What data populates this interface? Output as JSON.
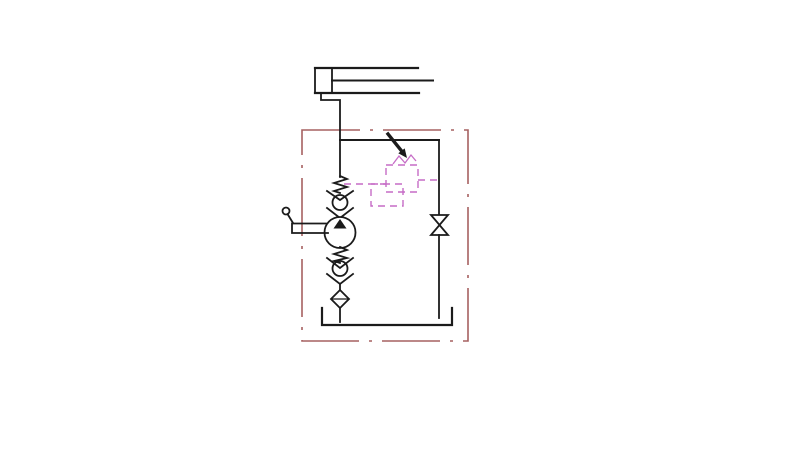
{
  "diagram": {
    "type": "hydraulic-hand-pump-circuit-schematic",
    "background": "#ffffff",
    "colors": {
      "line": "#1b1b1b",
      "enclosure": "#a66060",
      "pilot": "#c66cc6",
      "symbol_fill": "#ffffff"
    },
    "components": {
      "cylinder": "single-acting-cylinder-icon",
      "piston_rod": "piston-rod-icon",
      "hand_pump": "hand-pump-icon",
      "pump_lever": "hand-lever-icon",
      "check_valve_upper": "spring-check-valve-icon",
      "check_valve_lower": "spring-check-valve-icon",
      "relief_valve": "adjustable-relief-valve-icon",
      "adjustment_arrow": "adjustment-arrow-icon",
      "release_valve": "shut-off-valve-icon",
      "filter": "suction-filter-icon",
      "tank": "reservoir-tank-icon",
      "enclosure": "power-unit-boundary"
    }
  }
}
